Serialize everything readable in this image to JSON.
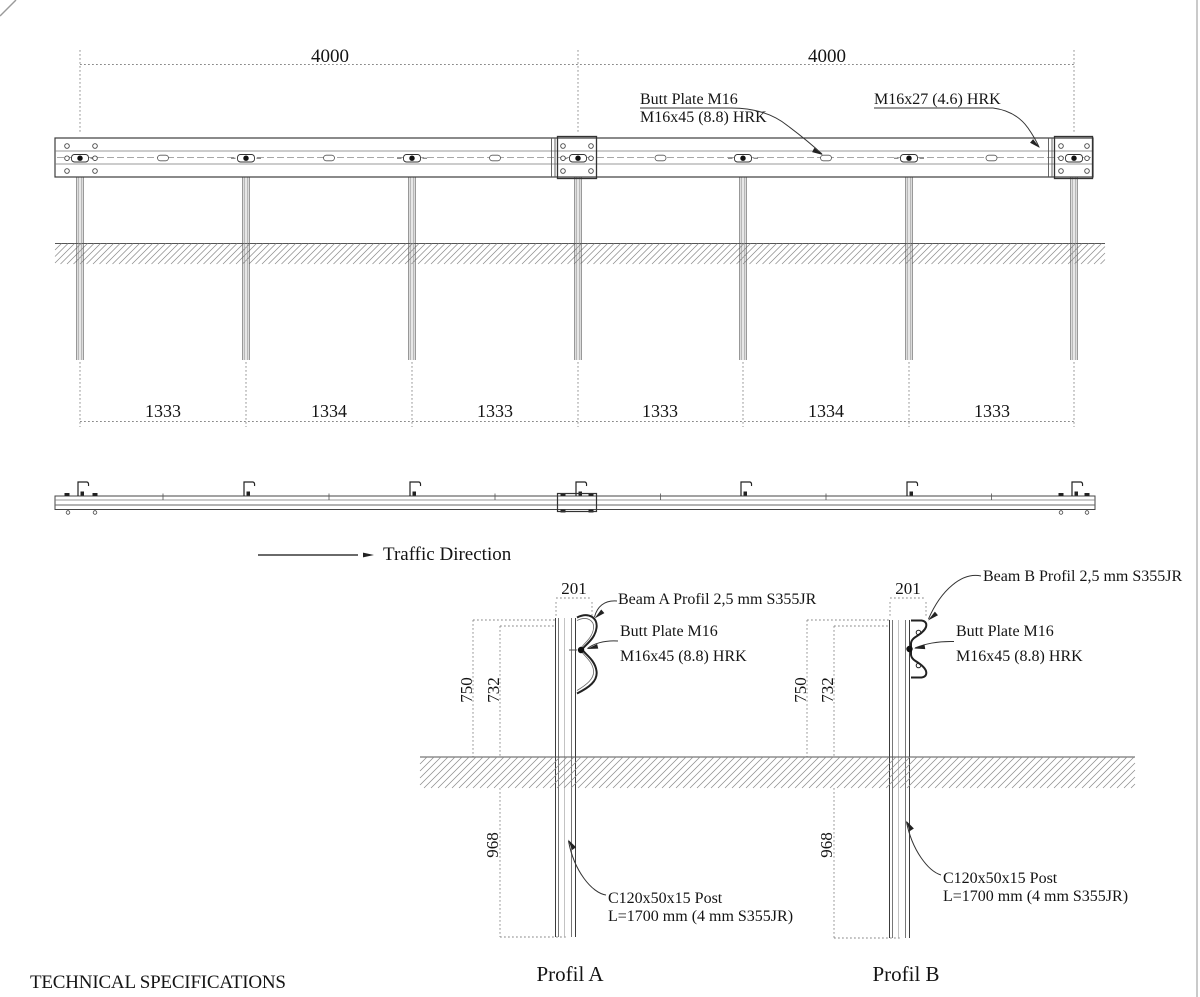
{
  "title": "TECHNICAL SPECIFICATIONS",
  "colors": {
    "line": "#3c3c3c",
    "dimension": "#8a8a8a",
    "text": "#141414",
    "border": "#b5b5b5"
  },
  "elevation": {
    "dims_4000": [
      "4000",
      "4000"
    ],
    "span_dims": [
      "1333",
      "1334",
      "1333",
      "1333",
      "1334",
      "1333"
    ],
    "butt_plate_label": {
      "line1": "Butt Plate M16",
      "line2": "M16x45 (8.8) HRK"
    },
    "bolt_label": "M16x27 (4.6) HRK"
  },
  "traffic_direction_label": "Traffic Direction",
  "details": {
    "a": {
      "title": "Profil A",
      "width_dim": "201",
      "height_dim": "750",
      "beam_height_dim": "732",
      "embed_dim": "968",
      "beam_label": "Beam A Profil 2,5 mm S355JR",
      "butt_plate": {
        "line1": "Butt Plate M16",
        "line2": "M16x45 (8.8) HRK"
      },
      "post_label": {
        "line1": "C120x50x15 Post",
        "line2": "L=1700 mm (4 mm S355JR)"
      }
    },
    "b": {
      "title": "Profil B",
      "width_dim": "201",
      "height_dim": "750",
      "beam_height_dim": "732",
      "embed_dim": "968",
      "beam_label": "Beam B Profil 2,5 mm S355JR",
      "butt_plate": {
        "line1": "Butt Plate M16",
        "line2": "M16x45 (8.8) HRK"
      },
      "post_label": {
        "line1": "C120x50x15 Post",
        "line2": "L=1700 mm (4 mm S355JR)"
      }
    }
  }
}
